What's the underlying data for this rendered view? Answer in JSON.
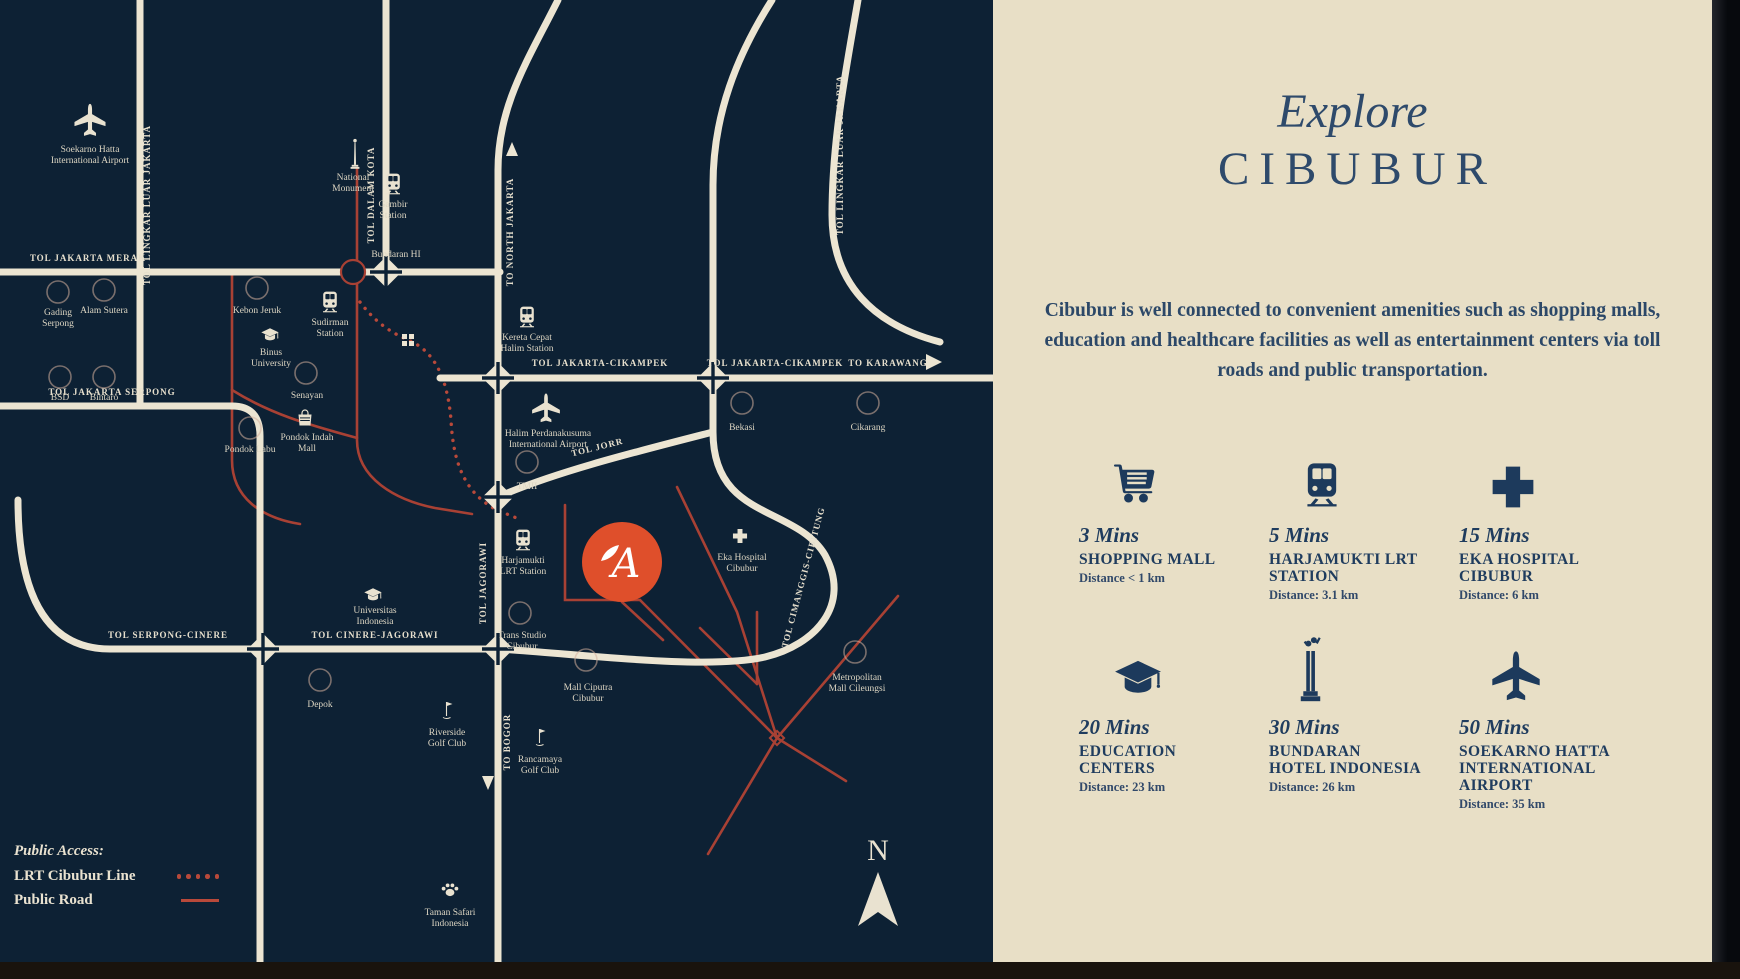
{
  "panel": {
    "heading_script": "Explore",
    "heading_main": "CIBUBUR",
    "paragraph": "Cibubur is well connected to convenient amenities such as shopping malls, education and healthcare facilities as well as entertainment centers via toll roads and public transportation.",
    "amenities": [
      {
        "icon": "cart",
        "mins": "3 Mins",
        "name": "SHOPPING MALL",
        "distance": "Distance < 1 km"
      },
      {
        "icon": "train",
        "mins": "5 Mins",
        "name": "HARJAMUKTI LRT\nSTATION",
        "distance": "Distance: 3.1 km"
      },
      {
        "icon": "cross",
        "mins": "15 Mins",
        "name": "EKA HOSPITAL\nCIBUBUR",
        "distance": "Distance: 6 km"
      },
      {
        "icon": "cap",
        "mins": "20 Mins",
        "name": "EDUCATION\nCENTERS",
        "distance": "Distance: 23 km"
      },
      {
        "icon": "monument",
        "mins": "30 Mins",
        "name": "BUNDARAN\nHOTEL INDONESIA",
        "distance": "Distance: 26 km"
      },
      {
        "icon": "plane",
        "mins": "50 Mins",
        "name": "SOEKARNO HATTA\nINTERNATIONAL\nAIRPORT",
        "distance": "Distance: 35 km"
      }
    ]
  },
  "legend": {
    "title": "Public Access:",
    "items": [
      {
        "label": "LRT Cibubur Line",
        "style": "dotted"
      },
      {
        "label": "Public Road",
        "style": "solid"
      }
    ]
  },
  "compass_label": "N",
  "colors": {
    "map_bg": "#0d2134",
    "panel_bg": "#e8dfc6",
    "road_cream": "#ece5d2",
    "public_road_red": "#a84134",
    "project_orange": "#df4f2b",
    "panel_navy": "#1d3a5c"
  },
  "map": {
    "road_labels": [
      {
        "t": "TOL JAKARTA MERAK",
        "x": 88,
        "y": 261
      },
      {
        "t": "TOL JAKARTA SERPONG",
        "x": 112,
        "y": 395
      },
      {
        "t": "TOL SERPONG-CINERE",
        "x": 168,
        "y": 638
      },
      {
        "t": "TOL CINERE-JAGORAWI",
        "x": 375,
        "y": 638
      },
      {
        "t": "TOL JAKARTA-CIKAMPEK",
        "x": 600,
        "y": 366
      },
      {
        "t": "TOL JAKARTA-CIKAMPEK",
        "x": 775,
        "y": 366
      },
      {
        "t": "TO KARAWANG",
        "x": 888,
        "y": 366
      },
      {
        "t": "TOL LINGKAR LUAR JAKARTA",
        "x": 150,
        "y": 205,
        "rot": -90
      },
      {
        "t": "TOL DALAM KOTA",
        "x": 374,
        "y": 195,
        "rot": -90
      },
      {
        "t": "TO NORTH JAKARTA",
        "x": 513,
        "y": 232,
        "rot": -90
      },
      {
        "t": "TOL LINGKAR LUAR JAKARTA",
        "x": 843,
        "y": 155,
        "rot": -90
      },
      {
        "t": "TOL JAGORAWI",
        "x": 486,
        "y": 583,
        "rot": -90
      },
      {
        "t": "TO BOGOR",
        "x": 510,
        "y": 742,
        "rot": -90
      },
      {
        "t": "TOL CIMANGGIS-CIBITUNG",
        "x": 806,
        "y": 578,
        "rot": -75
      },
      {
        "t": "TOL JORR",
        "x": 598,
        "y": 450,
        "rot": -14
      }
    ],
    "places": [
      {
        "lines": [
          "Soekarno Hatta",
          "International Airport"
        ],
        "x": 90,
        "y": 152
      },
      {
        "lines": [
          "National",
          "Monument"
        ],
        "x": 353,
        "y": 180
      },
      {
        "lines": [
          "Gambir",
          "Station"
        ],
        "x": 393,
        "y": 207
      },
      {
        "lines": [
          "Sudirman",
          "Station"
        ],
        "x": 330,
        "y": 325
      },
      {
        "lines": [
          "Bundaran HI"
        ],
        "x": 396,
        "y": 257
      },
      {
        "lines": [
          "Kebon Jeruk"
        ],
        "x": 257,
        "y": 313
      },
      {
        "lines": [
          "Binus",
          "University"
        ],
        "x": 271,
        "y": 355
      },
      {
        "lines": [
          "Senayan"
        ],
        "x": 307,
        "y": 398
      },
      {
        "lines": [
          "Pondok Indah",
          "Mall"
        ],
        "x": 307,
        "y": 440
      },
      {
        "lines": [
          "Pondok Labu"
        ],
        "x": 250,
        "y": 452
      },
      {
        "lines": [
          "Gading",
          "Serpong"
        ],
        "x": 58,
        "y": 315
      },
      {
        "lines": [
          "Alam Sutera"
        ],
        "x": 104,
        "y": 313
      },
      {
        "lines": [
          "BSD"
        ],
        "x": 60,
        "y": 400
      },
      {
        "lines": [
          "Bintaro"
        ],
        "x": 104,
        "y": 400
      },
      {
        "lines": [
          "Kereta Cepat",
          "Halim Station"
        ],
        "x": 527,
        "y": 340
      },
      {
        "lines": [
          "Halim Perdanakusuma",
          "International Airport"
        ],
        "x": 548,
        "y": 436
      },
      {
        "lines": [
          "TMII"
        ],
        "x": 527,
        "y": 489
      },
      {
        "lines": [
          "Harjamukti",
          "LRT Station"
        ],
        "x": 523,
        "y": 563
      },
      {
        "lines": [
          "Eka Hospital",
          "Cibubur"
        ],
        "x": 742,
        "y": 560
      },
      {
        "lines": [
          "Bekasi"
        ],
        "x": 742,
        "y": 430
      },
      {
        "lines": [
          "Cikarang"
        ],
        "x": 868,
        "y": 430
      },
      {
        "lines": [
          "Trans Studio",
          "Cibubur"
        ],
        "x": 522,
        "y": 638
      },
      {
        "lines": [
          "Mall Ciputra",
          "Cibubur"
        ],
        "x": 588,
        "y": 690
      },
      {
        "lines": [
          "Metropolitan",
          "Mall Cileungsi"
        ],
        "x": 857,
        "y": 680
      },
      {
        "lines": [
          "Depok"
        ],
        "x": 320,
        "y": 707
      },
      {
        "lines": [
          "Universitas",
          "Indonesia"
        ],
        "x": 375,
        "y": 613
      },
      {
        "lines": [
          "Riverside",
          "Golf Club"
        ],
        "x": 447,
        "y": 735
      },
      {
        "lines": [
          "Rancamaya",
          "Golf Club"
        ],
        "x": 540,
        "y": 762
      },
      {
        "lines": [
          "Taman Safari",
          "Indonesia"
        ],
        "x": 450,
        "y": 915
      }
    ]
  }
}
